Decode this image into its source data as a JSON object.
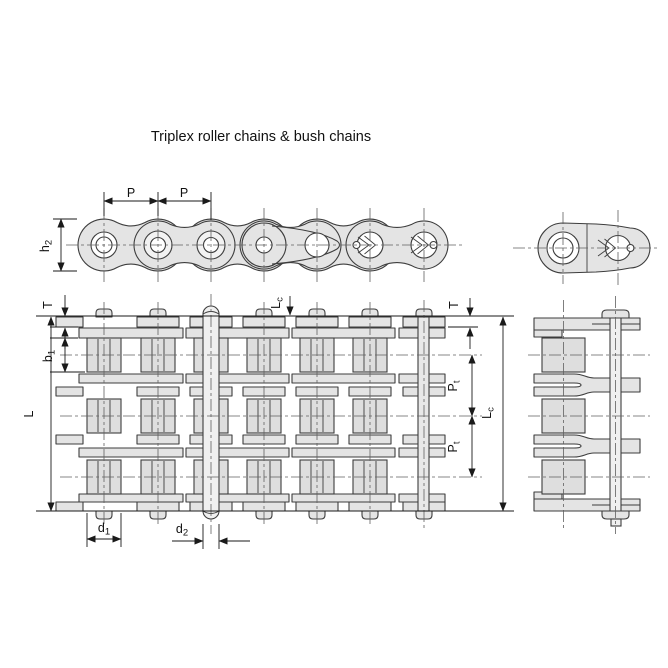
{
  "title": "Triplex roller chains & bush chains",
  "colors": {
    "plate_fill": "#e4e4e4",
    "roller_fill": "#dedede",
    "pin_fill": "#f0f0f0",
    "outline": "#3d3d3d",
    "dimension_line": "#1a1a1a",
    "centerline": "#606060",
    "background": "#ffffff"
  },
  "side_view": {
    "pitch_label_1": "P",
    "pitch_label_2": "P",
    "plate_height_label": {
      "main": "h",
      "sub": "2"
    }
  },
  "plan_view": {
    "plate_thickness_label_left": "T",
    "inner_width_label": {
      "main": "b",
      "sub": "1"
    },
    "pin_length_label": "L",
    "connecting_pin_length_label_top": {
      "main": "L",
      "sub": "c"
    },
    "plate_thickness_label_right": "T",
    "transverse_pitch_label_1": {
      "main": "P",
      "sub": "t"
    },
    "transverse_pitch_label_2": {
      "main": "P",
      "sub": "t"
    },
    "connecting_pin_length_label_right": {
      "main": "L",
      "sub": "c"
    },
    "roller_diameter_label": {
      "main": "d",
      "sub": "1"
    },
    "pin_diameter_label": {
      "main": "d",
      "sub": "2"
    }
  }
}
